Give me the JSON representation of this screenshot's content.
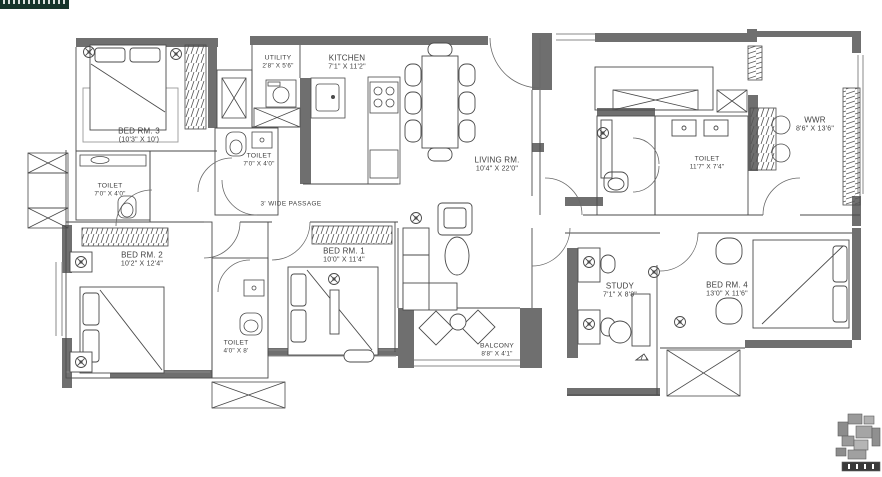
{
  "watermark": {
    "text": ""
  },
  "rooms": {
    "bed_rm_3": {
      "name": "BED RM. 3",
      "dims": "(10'3\" X 10')"
    },
    "toilet_bed3": {
      "name": "TOILET",
      "dims": "7'0\" X 4'0\""
    },
    "utility": {
      "name": "UTILITY",
      "dims": "2'8\" X 5'6\""
    },
    "kitchen": {
      "name": "KITCHEN",
      "dims": "7'1\" X 11'2\""
    },
    "toilet_common": {
      "name": "TOILET",
      "dims": "7'0\" X 4'0\""
    },
    "living": {
      "name": "LIVING RM.",
      "dims": "10'4\" X 22'0\""
    },
    "passage": {
      "name": "3' WIDE PASSAGE",
      "dims": ""
    },
    "toilet_master": {
      "name": "TOILET",
      "dims": "11'7\" X 7'4\""
    },
    "wwr": {
      "name": "WWR",
      "dims": "8'6\" X 13'6\""
    },
    "bed_rm_2": {
      "name": "BED RM. 2",
      "dims": "10'2\" X 12'4\""
    },
    "toilet_shared": {
      "name": "TOILET",
      "dims": "4'0\" X 8'"
    },
    "bed_rm_1": {
      "name": "BED RM. 1",
      "dims": "10'0\" X 11'4\""
    },
    "balcony": {
      "name": "BALCONY",
      "dims": "8'8\" X 4'1\""
    },
    "study": {
      "name": "STUDY",
      "dims": "7'1\" X 8'8\""
    },
    "bed_rm_4": {
      "name": "BED RM. 4",
      "dims": "13'0\" X 11'6\""
    }
  },
  "colors": {
    "wall": "#6f6f6f",
    "line": "#4a4a4a",
    "banner": "#16332a",
    "background": "#ffffff"
  }
}
